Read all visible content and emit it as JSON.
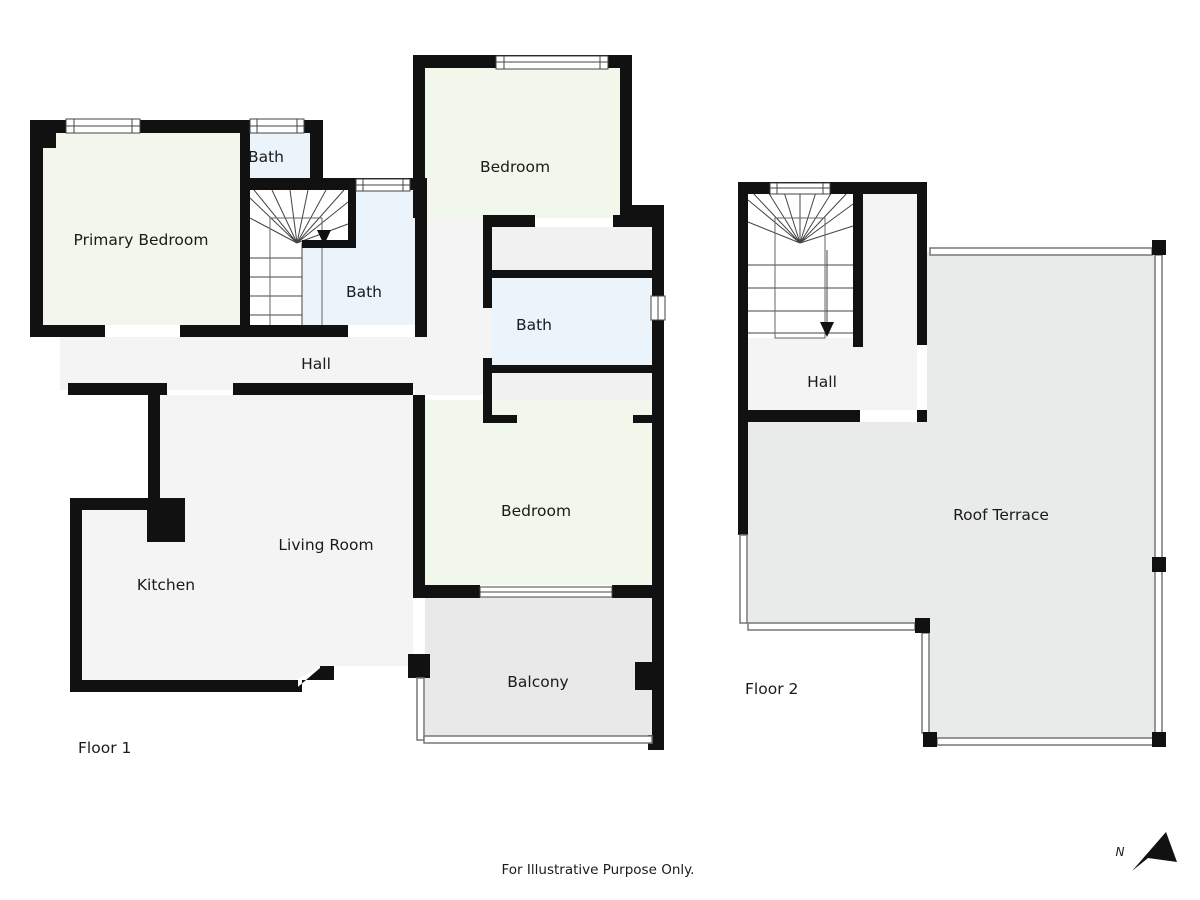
{
  "floor1": {
    "label": "Floor 1",
    "primary_bedroom": "Primary Bedroom",
    "bath_top": "Bath",
    "bath_mid": "Bath",
    "bedroom_top": "Bedroom",
    "bath_right": "Bath",
    "hall": "Hall",
    "bedroom_right": "Bedroom",
    "kitchen": "Kitchen",
    "living_room": "Living Room",
    "balcony": "Balcony"
  },
  "floor2": {
    "label": "Floor 2",
    "hall": "Hall",
    "roof_terrace": "Roof Terrace"
  },
  "footer": {
    "disclaimer": "For Illustrative Purpose Only."
  },
  "compass": {
    "north_label": "N"
  },
  "colors": {
    "wall": "#111111",
    "bedroom_fill": "#f2f7eb",
    "bath_fill": "#ebf4fa",
    "floor_fill": "#f4f4f4",
    "closet_fill": "#f1f1f1",
    "outdoor_fill": "#e9eaea"
  }
}
